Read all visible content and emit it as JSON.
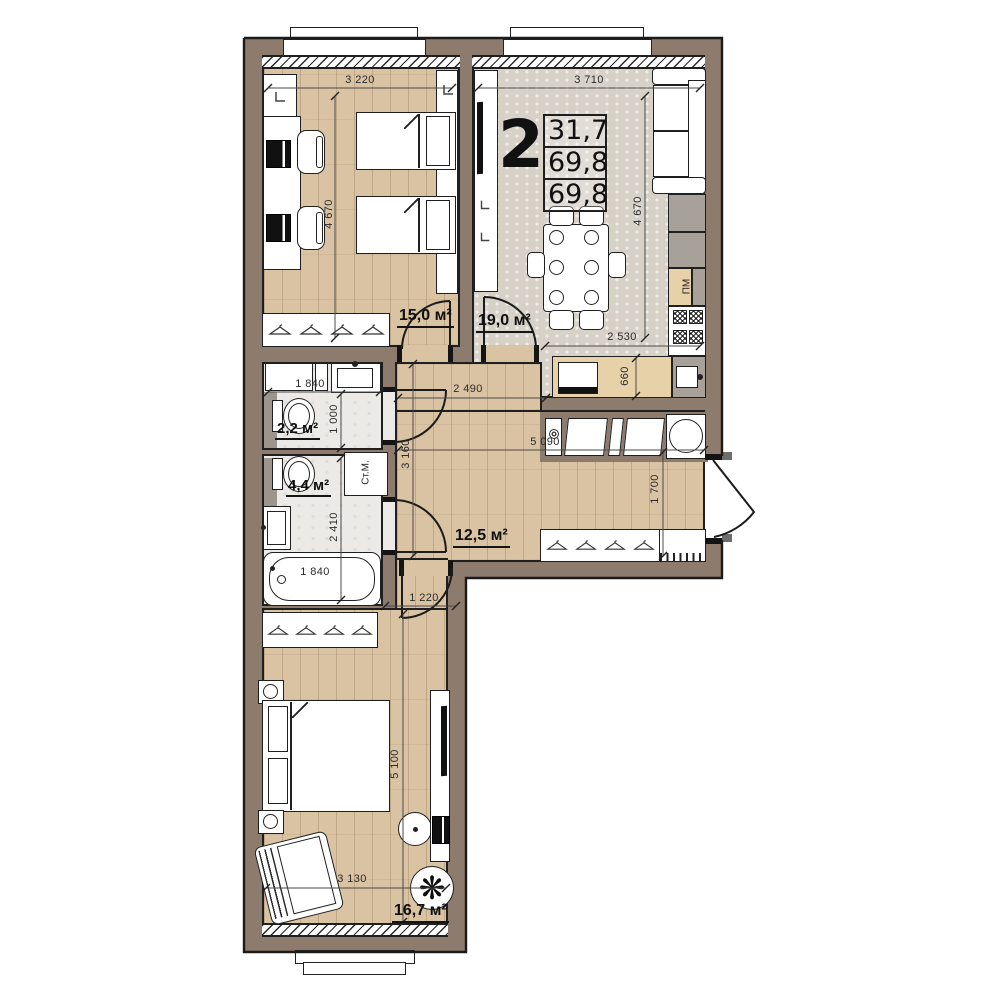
{
  "plan": {
    "type_label": "2",
    "area_rows": [
      "31,7",
      "69,8",
      "69,8"
    ]
  },
  "rooms": {
    "bedroom_top": {
      "area": "15,0 м²"
    },
    "kitchen_living": {
      "area": "19,0 м²",
      "dishwasher": "ПМ"
    },
    "wc": {
      "area": "2,2 м²"
    },
    "bathroom": {
      "area": "4,4 м²",
      "washing_machine": "Ст.М."
    },
    "hallway": {
      "area": "12,5 м²"
    },
    "bedroom_bottom": {
      "area": "16,7 м²"
    }
  },
  "dimensions": {
    "bedroom_top_width": "3 220",
    "kitchen_width": "3 710",
    "bedroom_top_depth": "4 670",
    "kitchen_depth": "4 670",
    "kitchen_run": "2 530",
    "counter_depth": "660",
    "wc_width": "1 840",
    "wc_depth": "1 000",
    "bathroom_depth": "2 410",
    "bathtub_length": "1 840",
    "hallway_top_width": "2 490",
    "hallway_left_depth": "3 160",
    "hallway_width": "5 090",
    "entry_depth": "1 700",
    "corridor_width": "1 220",
    "bedroom_bottom_depth": "5 100",
    "bedroom_bottom_width": "3 130"
  }
}
